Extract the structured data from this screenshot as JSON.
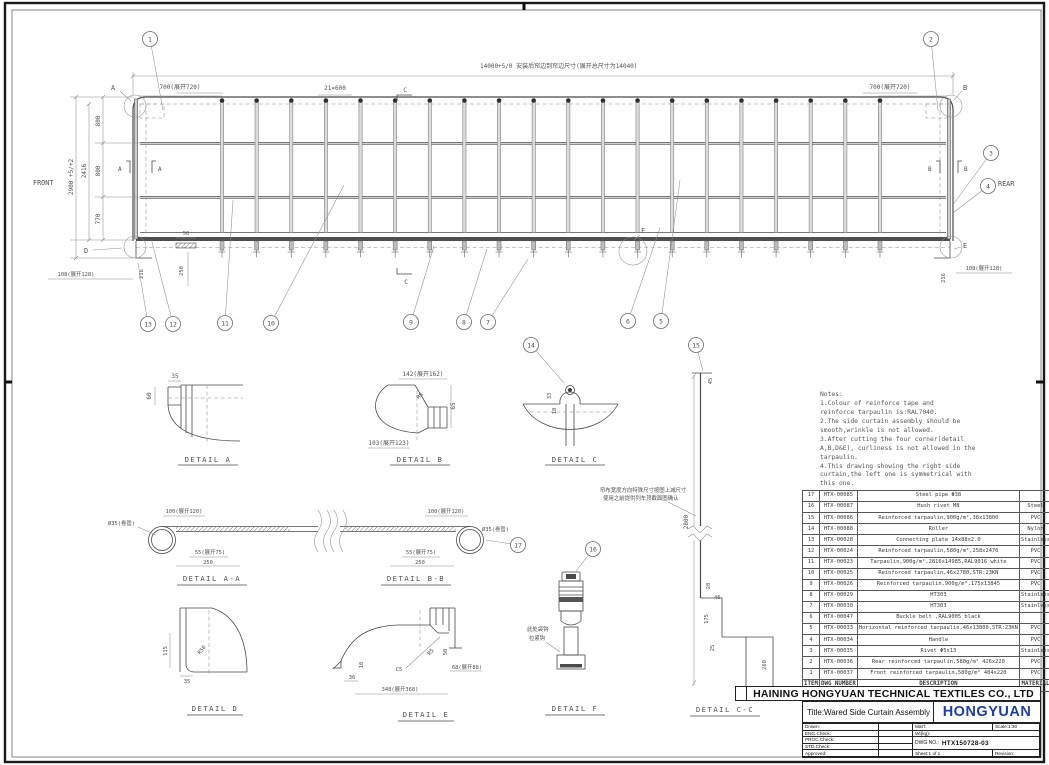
{
  "company": {
    "name": "HAINING HONGYUAN TECHNICAL TEXTILES CO., LTD",
    "logo": "HONGYUAN"
  },
  "titleblock": {
    "title": "Title:Wared Side Curtain Assembly",
    "drawn": "Drawn:",
    "eng": "ENG.Check:",
    "proc": "PROC.Check:",
    "std": "STD.Check:",
    "approved": "Approved:",
    "matl": "Mat'l:",
    "scale": "Scale:1:30",
    "wt": "Wt(kg):",
    "dwg_label": "DWG NO.:",
    "dwg_no": "HTX150728-03",
    "sheet": "Sheet:1 of 1",
    "revision": "Revision:"
  },
  "notes": {
    "text": "Notes:\n1.Colour of reinforce tape and\nreinforce tarpaulin is:RAL7040.\n2.The side curtain assembly should be\nsmooth,wrinkle is not allowed.\n3.After cutting the four corner(detail\nA,B,D&E), curliness is not allowed in the\ntarpaulin.\n4.This drawing showing the right side\ncurtain,the left one is symmetrical with\nthis one."
  },
  "balloons": [
    "1",
    "2",
    "3",
    "4",
    "5",
    "6",
    "7",
    "8",
    "9",
    "10",
    "11",
    "12",
    "13",
    "14",
    "15",
    "16",
    "17"
  ],
  "main": {
    "dim_overall": "14000+5/0 安装后帘边到帘边尺寸(展开总尺寸为14040)",
    "dim_700_left": "700(展开720)",
    "dim_bays": "21×600",
    "dim_700_right": "700(展开720)",
    "front": "FRONT",
    "rear": "REAR",
    "dim_800a": "800",
    "dim_800b": "800",
    "dim_770": "770",
    "dim_2416": "2416",
    "dim_2900": "2900 +5/+2",
    "dim_108_left": "108(展开128)",
    "dim_216_left": "216",
    "dim_50": "50",
    "dim_250": "250",
    "dim_108_right": "108(展开128)",
    "dim_216_right": "216",
    "mark_a": "A",
    "mark_b": "B",
    "mark_c": "C",
    "mark_d": "D",
    "mark_e": "E",
    "mark_f": "F",
    "sec_a": "A",
    "sec_b": "B"
  },
  "details": {
    "a": {
      "label": "DETAIL A",
      "d35": "35",
      "d60": "60"
    },
    "b": {
      "label": "DETAIL B",
      "d142": "142(展开162)",
      "d65": "65",
      "d103": "103(展开123)",
      "r5": "R5"
    },
    "c": {
      "label": "DETAIL C",
      "d33": "33",
      "d18": "18"
    },
    "aa": {
      "label": "DETAIL A-A",
      "d100": "100(展开120)",
      "d35": "Ø35(卷管)",
      "d55": "55(展开75)",
      "d250": "250"
    },
    "bb": {
      "label": "DETAIL B-B",
      "d100": "100(展开120)",
      "d35": "Ø35(卷管)",
      "d55": "55(展开75)",
      "d250": "250"
    },
    "dd": {
      "label": "DETAIL D",
      "d115": "115",
      "d35": "35",
      "r50": "R50"
    },
    "e": {
      "label": "DETAIL E",
      "d36": "36",
      "d10": "10",
      "c5": "C5",
      "r5": "R5",
      "d50": "50",
      "d68": "68(展开88)",
      "d348": "348(展开368)"
    },
    "f": {
      "label": "DETAIL F",
      "note1": "此处袋钩",
      "note2": "拉紧钩"
    },
    "cc": {
      "label": "DETAIL C-C",
      "d45": "45",
      "d2800": "2800",
      "d20": "20",
      "d46": "46",
      "d175": "175",
      "d25": "25",
      "d260": "260",
      "note1": "帘布宽度方向特殊尺寸按图上减尺寸",
      "note2": "使用之前提供列车顶截面图确认"
    }
  },
  "bom": {
    "headers": [
      "ITEM",
      "DWG NUMBER",
      "DESCRIPTION",
      "MATERIAL",
      "WT(KG)",
      "QTY",
      "REMARK"
    ],
    "rows": [
      [
        "17",
        "HTX-00085",
        "Steel pipe Φ38",
        "",
        "",
        "2",
        ""
      ],
      [
        "16",
        "HTX-00087",
        "Hush rivet M8",
        "Steel",
        "0.010",
        "44",
        ""
      ],
      [
        "15",
        "HTX-00086",
        "Reinforced tarpaulin,900g/m²,38x13800",
        "PVC",
        "0.280",
        "1",
        ""
      ],
      [
        "14",
        "HTX-00088",
        "Roller",
        "Nylon",
        "0.280",
        "22",
        ""
      ],
      [
        "13",
        "HTX-00028",
        "Connecting plate 14x88x2.0",
        "Stainless",
        "0.280",
        "30",
        ""
      ],
      [
        "12",
        "HTX-00024",
        "Reinforced tarpaulin,580g/m²,258x2476",
        "PVC",
        "",
        "2",
        ""
      ],
      [
        "11",
        "HTX-00023",
        "Tarpaulin,900g/m²,2816x14985,RAL9016 white",
        "PVC",
        "37.88",
        "1",
        ""
      ],
      [
        "10",
        "HTX-00025",
        "Reinforced tarpaulin,46x2780,STR:23KN",
        "PVC",
        "0.300",
        "22",
        ""
      ],
      [
        "9",
        "HTX-00026",
        "Reinforced tarpaulin,900g/m²,175x13845",
        "PVC",
        "1.340",
        "1",
        ""
      ],
      [
        "8",
        "HTX-00029",
        "HT303",
        "Stainless",
        "0.480",
        "22",
        ""
      ],
      [
        "7",
        "HTX-00030",
        "HT303",
        "Stainless",
        "0.020",
        "22",
        ""
      ],
      [
        "6",
        "HTX-00047",
        "Buckle belt ,RAL9005 black",
        "",
        "0.050",
        "22",
        ""
      ],
      [
        "5",
        "HTX-00033",
        "Horizontal reinforced tarpaulin,46x13800,STR:23KN",
        "PVC",
        "0.550",
        "3",
        ""
      ],
      [
        "4",
        "HTX-00034",
        "Handle",
        "PVC",
        "0.280",
        "2",
        ""
      ],
      [
        "3",
        "HTX-00035",
        "Rivet Φ5x13",
        "Stainless",
        "0.010",
        "8",
        ""
      ],
      [
        "2",
        "HTX-00036",
        "Rear reinforced tarpaulin,580g/m² 426x220",
        "PVC",
        "0.050",
        "1",
        ""
      ],
      [
        "1",
        "HTX-00037",
        "Front reinforced tarpaulin,580g/m² 404x220",
        "PVC",
        "0.040",
        "1",
        ""
      ]
    ]
  }
}
